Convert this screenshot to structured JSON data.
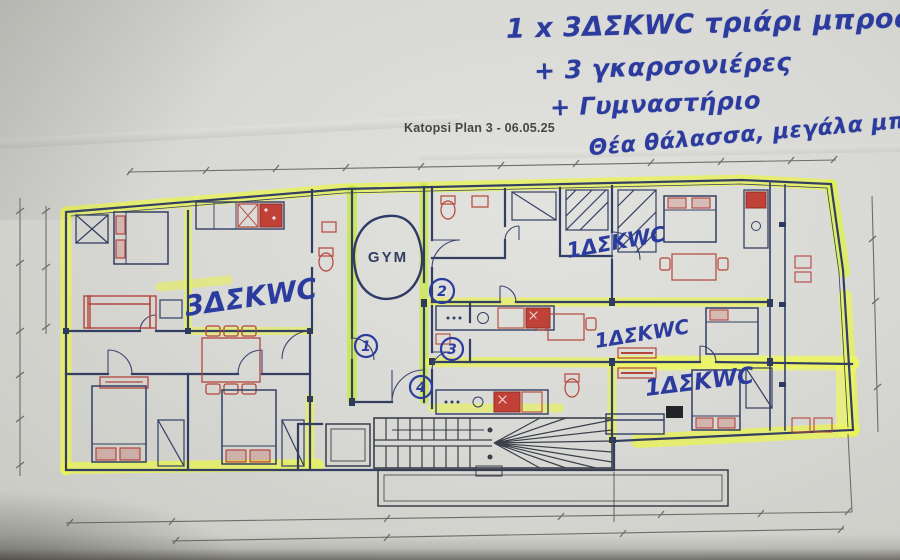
{
  "notes": {
    "line1": "1 x 3ΔΣΚWC τριάρι μπροστά",
    "line2": "+ 3 γκαρσονιέρες",
    "line3": "+ Γυμναστήριο",
    "line4": "Θέα θάλασσα, μεγάλα μπαλκόνια"
  },
  "plan": {
    "title": "Katopsi Plan 3 - 06.05.25",
    "gym_label": "GYM",
    "unit_labels": {
      "large": "3ΔΣΚWC",
      "top_right": "1ΔΣΚWC",
      "middle_right": "1ΔΣΚWC",
      "bottom_right": "1ΔΣΚWC"
    },
    "circled_numbers": {
      "n1": "1",
      "n2": "2",
      "n3": "3",
      "n4": "4"
    }
  },
  "colors": {
    "paper": "#d8d8d4",
    "highlighter_yellow": "#e8f257",
    "wall_navy": "#333e63",
    "furniture_red": "#b5453c",
    "pen_ink_blue": "#2c3c9e",
    "pencil_gray": "#6e6e68"
  }
}
